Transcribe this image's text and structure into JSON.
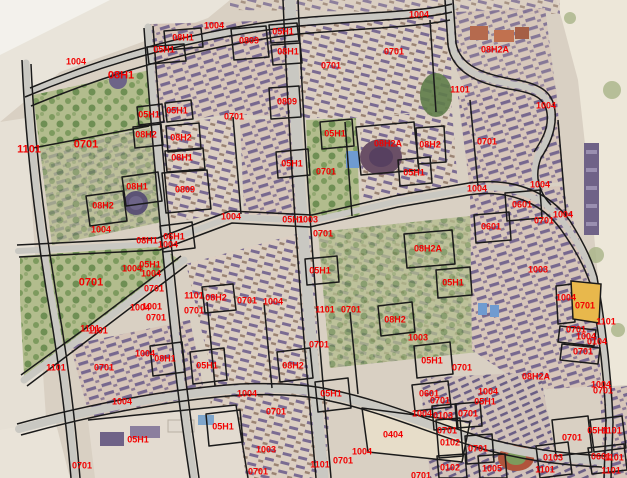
{
  "colors": {
    "label_red": "#f20000",
    "boundary_black": "#1a1a1a",
    "road_gray": "#c9c8c2",
    "highlight_parcel_yellow": "#e8b84c",
    "park_green": "#b2bc8d",
    "roof_purple": "#77688f",
    "photo_base_tan": "#d9d0c3"
  },
  "parcel_labels": [
    {
      "t": "1004",
      "x": 214,
      "y": 26
    },
    {
      "t": "08H1",
      "x": 183,
      "y": 38
    },
    {
      "t": "05H1",
      "x": 164,
      "y": 50
    },
    {
      "t": "0809",
      "x": 249,
      "y": 41
    },
    {
      "t": "05H1",
      "x": 283,
      "y": 32
    },
    {
      "t": "08H1",
      "x": 288,
      "y": 52
    },
    {
      "t": "1004",
      "x": 419,
      "y": 15
    },
    {
      "t": "0701",
      "x": 394,
      "y": 52
    },
    {
      "t": "08H2A",
      "x": 495,
      "y": 50
    },
    {
      "t": "1004",
      "x": 546,
      "y": 106
    },
    {
      "t": "1004",
      "x": 76,
      "y": 62
    },
    {
      "t": "08H1",
      "x": 121,
      "y": 76,
      "big": true
    },
    {
      "t": "0809",
      "x": 287,
      "y": 102
    },
    {
      "t": "05H1",
      "x": 149,
      "y": 115
    },
    {
      "t": "05H1",
      "x": 177,
      "y": 111
    },
    {
      "t": "0701",
      "x": 234,
      "y": 117
    },
    {
      "t": "0701",
      "x": 331,
      "y": 66
    },
    {
      "t": "1101",
      "x": 460,
      "y": 90
    },
    {
      "t": "1101",
      "x": 29,
      "y": 150,
      "big": true
    },
    {
      "t": "0701",
      "x": 86,
      "y": 145,
      "big": true
    },
    {
      "t": "08H2",
      "x": 146,
      "y": 135
    },
    {
      "t": "08H2",
      "x": 181,
      "y": 138
    },
    {
      "t": "08H1",
      "x": 182,
      "y": 158
    },
    {
      "t": "0809",
      "x": 185,
      "y": 190
    },
    {
      "t": "05H1",
      "x": 335,
      "y": 134
    },
    {
      "t": "08H2A",
      "x": 388,
      "y": 144
    },
    {
      "t": "08H2",
      "x": 430,
      "y": 145
    },
    {
      "t": "0701",
      "x": 326,
      "y": 172
    },
    {
      "t": "05H1",
      "x": 414,
      "y": 173
    },
    {
      "t": "05H1",
      "x": 292,
      "y": 164
    },
    {
      "t": "0701",
      "x": 487,
      "y": 142
    },
    {
      "t": "08H1",
      "x": 137,
      "y": 187
    },
    {
      "t": "08H2",
      "x": 103,
      "y": 206
    },
    {
      "t": "1004",
      "x": 101,
      "y": 230
    },
    {
      "t": "1004",
      "x": 231,
      "y": 217
    },
    {
      "t": "05H1",
      "x": 293,
      "y": 220
    },
    {
      "t": "1003",
      "x": 308,
      "y": 220
    },
    {
      "t": "0701",
      "x": 323,
      "y": 234
    },
    {
      "t": "08H2A",
      "x": 428,
      "y": 249
    },
    {
      "t": "06H1",
      "x": 174,
      "y": 237
    },
    {
      "t": "1004",
      "x": 168,
      "y": 245
    },
    {
      "t": "08H1",
      "x": 147,
      "y": 241
    },
    {
      "t": "1004",
      "x": 477,
      "y": 189
    },
    {
      "t": "1004",
      "x": 540,
      "y": 185
    },
    {
      "t": "0601",
      "x": 522,
      "y": 205
    },
    {
      "t": "1004",
      "x": 563,
      "y": 215
    },
    {
      "t": "0601",
      "x": 491,
      "y": 227
    },
    {
      "t": "0701",
      "x": 544,
      "y": 221
    },
    {
      "t": "1003",
      "x": 538,
      "y": 270
    },
    {
      "t": "05H1",
      "x": 453,
      "y": 283
    },
    {
      "t": "05H1",
      "x": 320,
      "y": 271
    },
    {
      "t": "0701",
      "x": 91,
      "y": 283,
      "big": true
    },
    {
      "t": "1004",
      "x": 132,
      "y": 269
    },
    {
      "t": "05H1",
      "x": 150,
      "y": 265
    },
    {
      "t": "1004",
      "x": 151,
      "y": 274
    },
    {
      "t": "0701",
      "x": 154,
      "y": 289
    },
    {
      "t": "1004",
      "x": 140,
      "y": 308
    },
    {
      "t": "1001",
      "x": 152,
      "y": 307
    },
    {
      "t": "0701",
      "x": 156,
      "y": 318
    },
    {
      "t": "1101",
      "x": 90,
      "y": 329
    },
    {
      "t": "1101",
      "x": 98,
      "y": 331
    },
    {
      "t": "1101",
      "x": 194,
      "y": 296
    },
    {
      "t": "08H2",
      "x": 216,
      "y": 298
    },
    {
      "t": "0701",
      "x": 247,
      "y": 301
    },
    {
      "t": "1004",
      "x": 273,
      "y": 302
    },
    {
      "t": "0701",
      "x": 194,
      "y": 311
    },
    {
      "t": "1101",
      "x": 325,
      "y": 310
    },
    {
      "t": "0701",
      "x": 351,
      "y": 310
    },
    {
      "t": "0701",
      "x": 319,
      "y": 345
    },
    {
      "t": "08H2",
      "x": 395,
      "y": 320
    },
    {
      "t": "1003",
      "x": 418,
      "y": 338
    },
    {
      "t": "05H1",
      "x": 432,
      "y": 361
    },
    {
      "t": "0701",
      "x": 462,
      "y": 368
    },
    {
      "t": "1004",
      "x": 566,
      "y": 298
    },
    {
      "t": "0701",
      "x": 585,
      "y": 306
    },
    {
      "t": "1101",
      "x": 606,
      "y": 322
    },
    {
      "t": "0701",
      "x": 576,
      "y": 330
    },
    {
      "t": "1004",
      "x": 586,
      "y": 337
    },
    {
      "t": "0104",
      "x": 597,
      "y": 342
    },
    {
      "t": "0701",
      "x": 583,
      "y": 352
    },
    {
      "t": "1101",
      "x": 56,
      "y": 368
    },
    {
      "t": "0701",
      "x": 104,
      "y": 368
    },
    {
      "t": "1004",
      "x": 145,
      "y": 354
    },
    {
      "t": "08H1",
      "x": 165,
      "y": 359
    },
    {
      "t": "05H1",
      "x": 207,
      "y": 366
    },
    {
      "t": "08H2",
      "x": 293,
      "y": 366
    },
    {
      "t": "1004",
      "x": 122,
      "y": 402
    },
    {
      "t": "05H1",
      "x": 138,
      "y": 440
    },
    {
      "t": "0701",
      "x": 82,
      "y": 466
    },
    {
      "t": "1004",
      "x": 247,
      "y": 394
    },
    {
      "t": "0701",
      "x": 276,
      "y": 412
    },
    {
      "t": "05H1",
      "x": 223,
      "y": 427
    },
    {
      "t": "05H1",
      "x": 331,
      "y": 394
    },
    {
      "t": "1003",
      "x": 266,
      "y": 450
    },
    {
      "t": "0701",
      "x": 258,
      "y": 472
    },
    {
      "t": "1101",
      "x": 320,
      "y": 465
    },
    {
      "t": "0701",
      "x": 343,
      "y": 461
    },
    {
      "t": "1004",
      "x": 362,
      "y": 452
    },
    {
      "t": "0404",
      "x": 393,
      "y": 435
    },
    {
      "t": "0601",
      "x": 429,
      "y": 394
    },
    {
      "t": "0701",
      "x": 440,
      "y": 401
    },
    {
      "t": "1004",
      "x": 422,
      "y": 414
    },
    {
      "t": "0103",
      "x": 443,
      "y": 416
    },
    {
      "t": "0701",
      "x": 468,
      "y": 414
    },
    {
      "t": "1004",
      "x": 488,
      "y": 392
    },
    {
      "t": "05H1",
      "x": 485,
      "y": 402
    },
    {
      "t": "0701",
      "x": 447,
      "y": 431
    },
    {
      "t": "0102",
      "x": 450,
      "y": 443
    },
    {
      "t": "0701",
      "x": 478,
      "y": 449
    },
    {
      "t": "0102",
      "x": 450,
      "y": 468
    },
    {
      "t": "1005",
      "x": 492,
      "y": 469
    },
    {
      "t": "08H2A",
      "x": 536,
      "y": 377
    },
    {
      "t": "1004",
      "x": 601,
      "y": 385
    },
    {
      "t": "0701",
      "x": 603,
      "y": 391
    },
    {
      "t": "0701",
      "x": 572,
      "y": 438
    },
    {
      "t": "05H1",
      "x": 598,
      "y": 431
    },
    {
      "t": "1101",
      "x": 612,
      "y": 431
    },
    {
      "t": "0103",
      "x": 553,
      "y": 458
    },
    {
      "t": "0601",
      "x": 601,
      "y": 457
    },
    {
      "t": "1101",
      "x": 614,
      "y": 458
    },
    {
      "t": "1101",
      "x": 611,
      "y": 471
    },
    {
      "t": "1101",
      "x": 545,
      "y": 470
    },
    {
      "t": "0701",
      "x": 421,
      "y": 476
    }
  ]
}
